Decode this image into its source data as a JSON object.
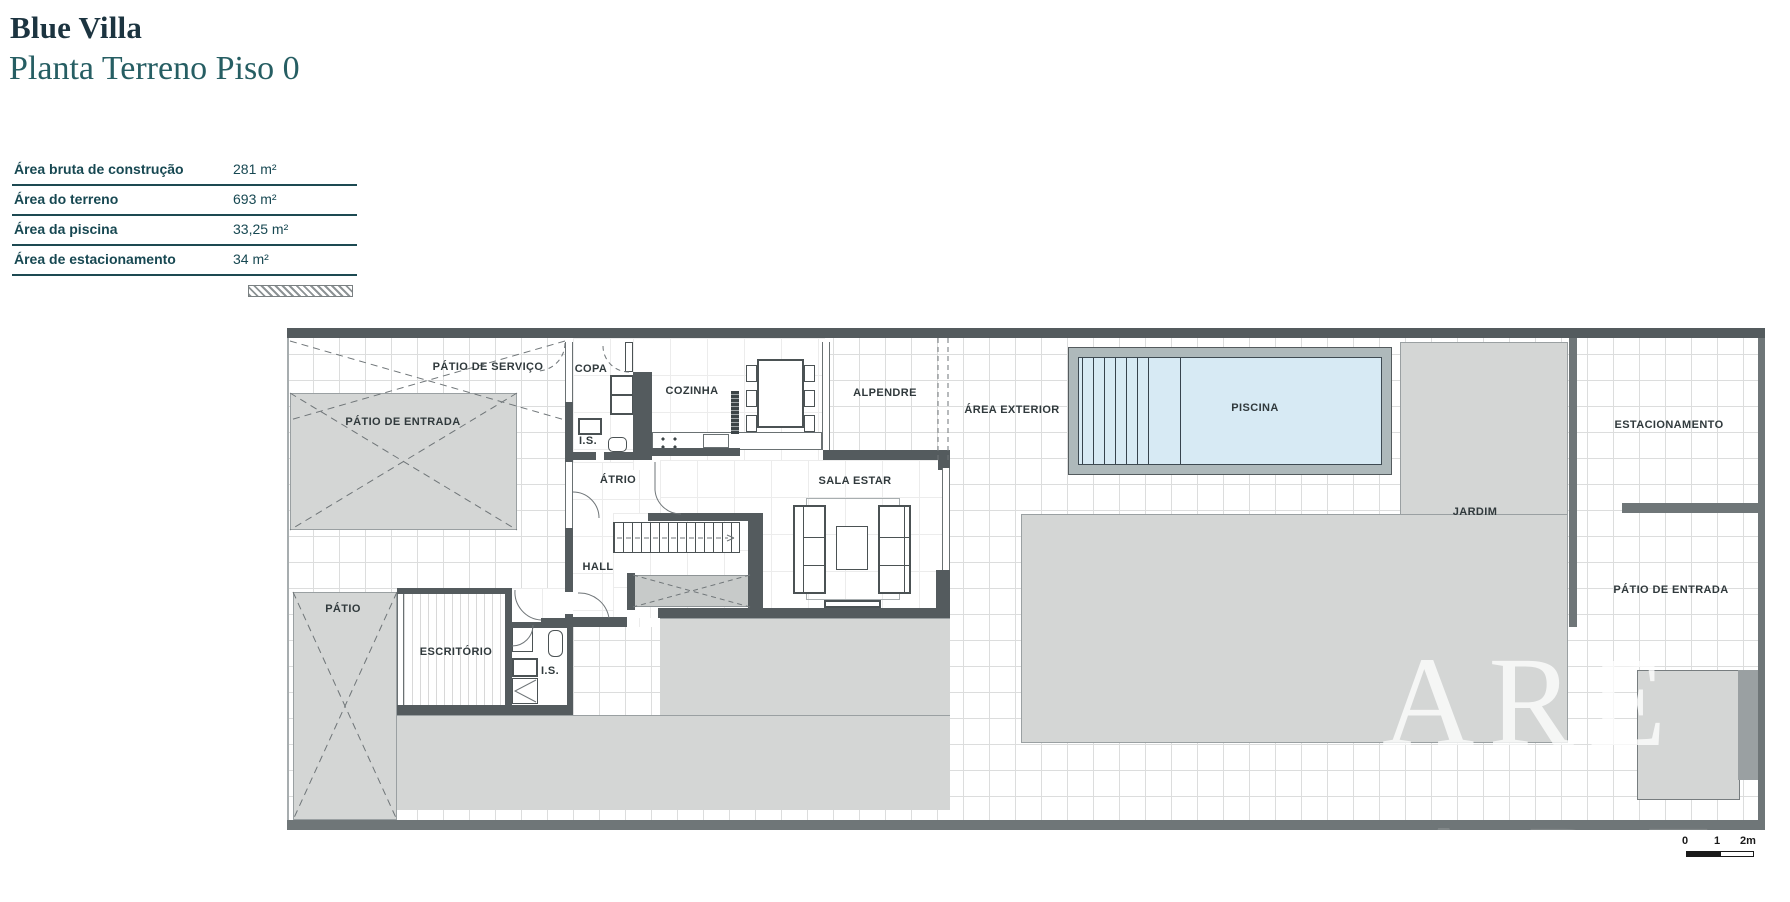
{
  "header": {
    "title": "Blue Villa",
    "subtitle": "Planta Terreno Piso 0"
  },
  "info_table": {
    "rows": [
      {
        "label": "Área bruta de construção",
        "value": "281 m²"
      },
      {
        "label": "Área do terreno",
        "value": "693 m²"
      },
      {
        "label": "Área da piscina",
        "value": "33,25 m²"
      },
      {
        "label": "Área de estacionamento",
        "value": "34 m²"
      }
    ]
  },
  "plan": {
    "rooms": {
      "patio_servico": "PÁTIO DE SERVIÇO",
      "patio_entrada_left": "PÁTIO DE ENTRADA",
      "copa": "COPA",
      "cozinha": "COZINHA",
      "alpendre": "ALPENDRE",
      "area_exterior": "ÁREA EXTERIOR",
      "piscina": "PISCINA",
      "estacionamento": "ESTACIONAMENTO",
      "jardim": "JARDIM",
      "patio_entrada_right": "PÁTIO DE ENTRADA",
      "is_top": "I.S.",
      "atrio": "ÁTRIO",
      "sala_estar": "SALA ESTAR",
      "hall": "HALL",
      "patio": "PÁTIO",
      "escritorio": "ESCRITÓRIO",
      "is_bottom": "I.S."
    },
    "scale_bar": {
      "start": "0",
      "mid": "1",
      "end": "2m"
    },
    "watermark": "ARE",
    "colors": {
      "accent": "#1d4a52",
      "wall": "#545b5e",
      "patio_fill": "#d4d6d5",
      "pool_water": "#d7eaf4",
      "pool_edge": "#aeb9bb"
    }
  }
}
